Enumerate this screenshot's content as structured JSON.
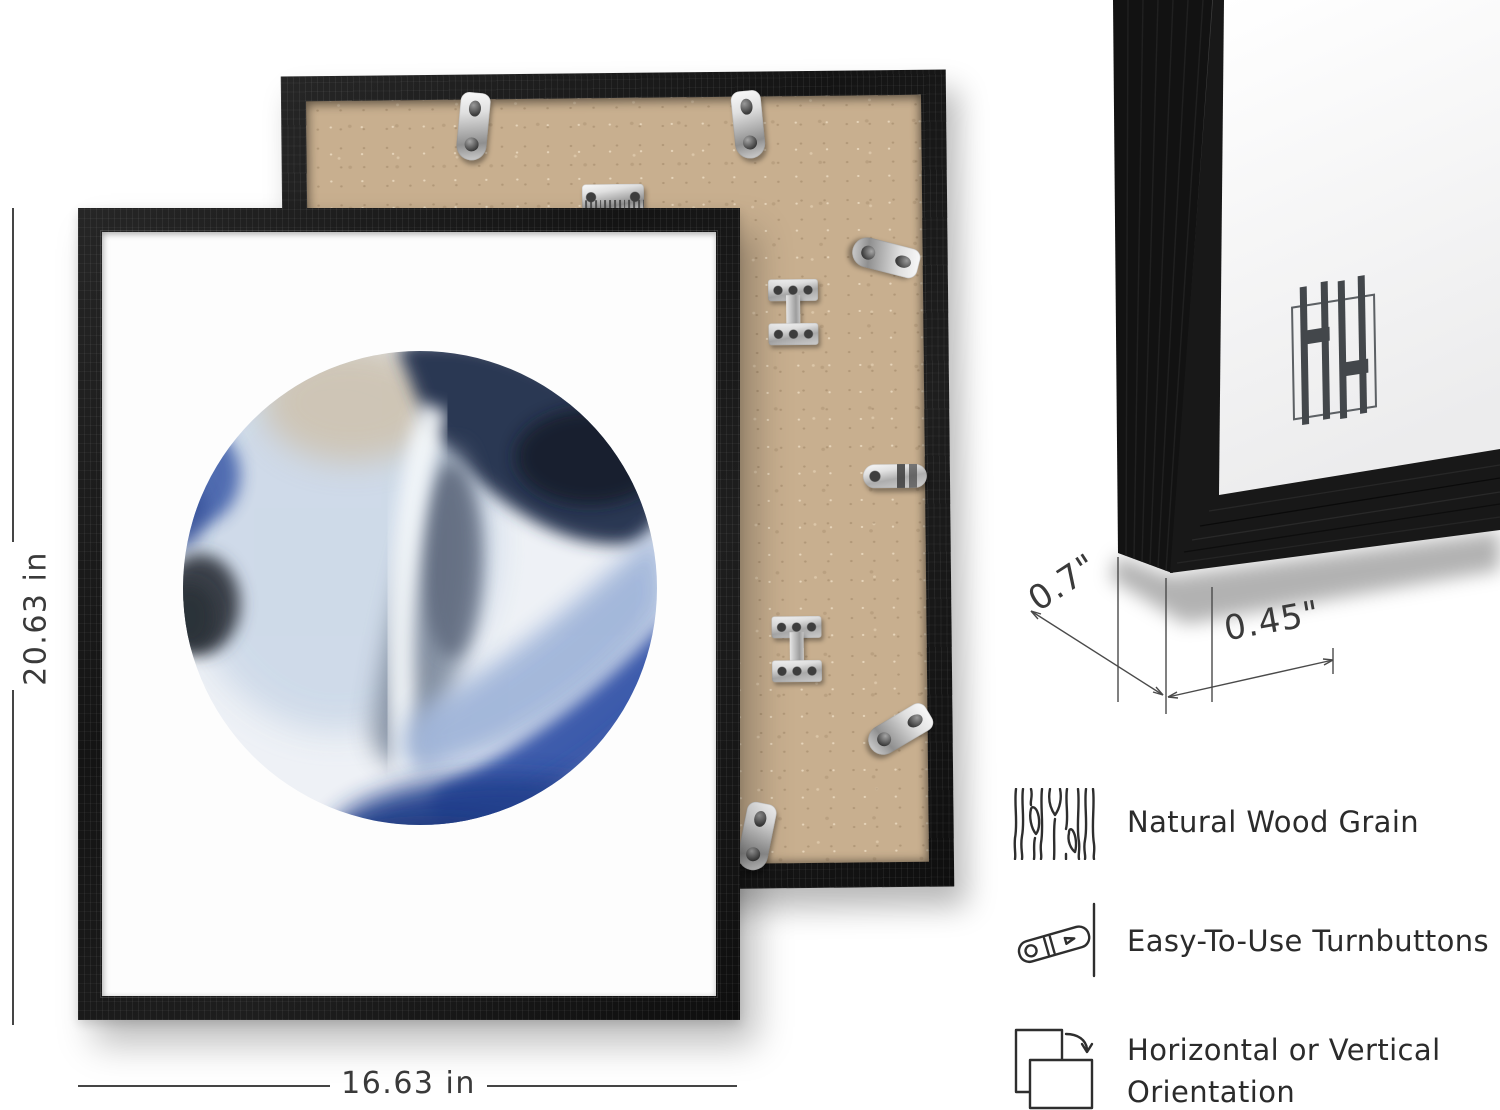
{
  "page": {
    "background_color": "#ffffff"
  },
  "brand": {
    "monogram": "HH"
  },
  "front_frame": {
    "description": "Black wood picture frame, front view, white art print with abstract blue watercolor circle",
    "frame_color": "#1a1a1a",
    "paper_color": "#fdfdfd",
    "art_palette": [
      "#2b3752",
      "#161d2b",
      "#7e8a9c",
      "#cdd9e8",
      "#cec0a9",
      "#4a66ad",
      "#3a4149",
      "#a0b5d9",
      "#3e5cac",
      "#2e4a9a"
    ]
  },
  "back_frame": {
    "description": "Frame back view with MDF backing board and silver metal hardware",
    "board_color": "#c8af8f",
    "hardware": [
      {
        "name": "turnbutton-tab-top-left"
      },
      {
        "name": "turnbutton-tab-top-right"
      },
      {
        "name": "sawtooth-hanger"
      },
      {
        "name": "angled-turnbutton-right-top"
      },
      {
        "name": "corner-bracket-upper"
      },
      {
        "name": "horizontal-turnbutton-tab"
      },
      {
        "name": "corner-bracket-lower"
      },
      {
        "name": "angled-turnbutton-right-bottom"
      },
      {
        "name": "turnbutton-tab-bottom"
      }
    ]
  },
  "corner_frame": {
    "description": "Close-up of frame corner profile showing wood grain, side depth and face width"
  },
  "dimensions": {
    "height_label": "20.63 in",
    "width_label": "16.63 in",
    "depth_label": "0.7\"",
    "face_label": "0.45\""
  },
  "features": [
    {
      "icon": "wood-grain-icon",
      "label": "Natural Wood Grain"
    },
    {
      "icon": "turnbutton-icon",
      "label": "Easy-To-Use Turnbuttons"
    },
    {
      "icon": "orientation-icon",
      "label_line1": "Horizontal or Vertical",
      "label_line2": "Orientation"
    }
  ],
  "colors": {
    "frame_black": "#1a1a1a",
    "mdf_tan": "#c8af8f",
    "metal_silver": "#cccccc",
    "annotation_gray": "#3a3a3a"
  }
}
